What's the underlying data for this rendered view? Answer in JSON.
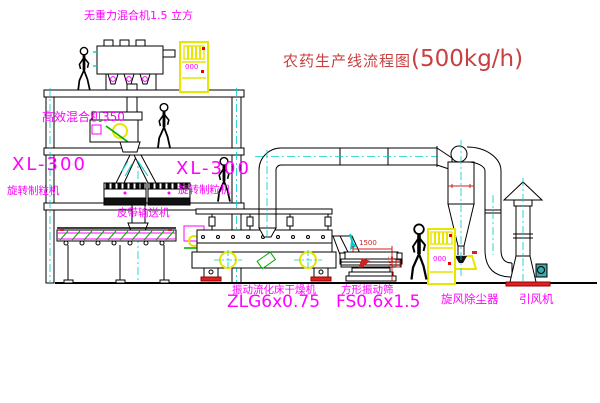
{
  "title": {
    "text": "农药生产线流程图",
    "capacity": "(500kg/h)"
  },
  "annotations": {
    "top_mixer": "无重力混合机1.5 立方",
    "high_efficiency_mixer": "高效混合机350",
    "granulator_left": {
      "model": "XL-300",
      "name": "旋转制粒机"
    },
    "granulator_right": {
      "model": "XL-300",
      "name": "旋转制粒机"
    },
    "belt_conveyor": "皮带输送机",
    "fluid_bed_dryer": {
      "name": "振动流化床干燥机",
      "model": "ZLG6x0.75"
    },
    "square_screen": {
      "name": "方形振动筛",
      "model": "FS0.6x1.5"
    },
    "cyclone": "旋风除尘器",
    "fan": "引风机"
  },
  "dimensions": {
    "screen_length": "1500",
    "screen_height": "550"
  },
  "displays": {
    "cabinet1": "000",
    "cabinet2": "000"
  },
  "colors": {
    "label_magenta": "#FF00FF",
    "title_red": "#C84040",
    "centerline_cyan": "#00CCCC",
    "cabinet_yellow": "#E6E600",
    "accent_green": "#00AA00",
    "dim_red": "#CC2222"
  }
}
